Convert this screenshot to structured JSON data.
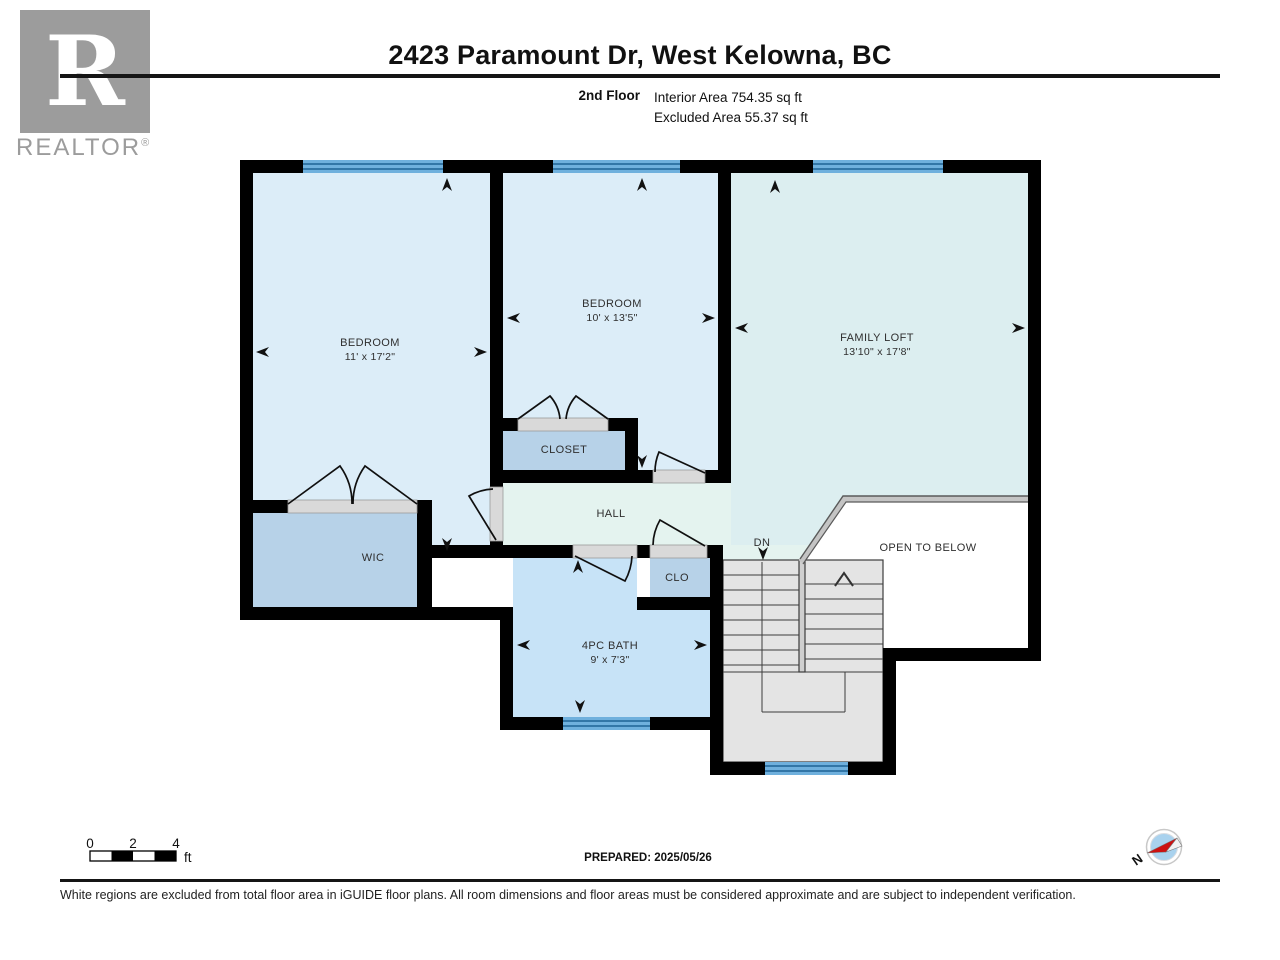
{
  "header": {
    "title": "2423 Paramount Dr, West Kelowna, BC",
    "floor_label": "2nd Floor",
    "interior_area": "Interior Area 754.35 sq ft",
    "excluded_area": "Excluded Area 55.37 sq ft",
    "logo": {
      "letter": "R",
      "wordmark": "REALTOR",
      "reg": "®"
    }
  },
  "rooms": {
    "bedroom1": {
      "name": "BEDROOM",
      "dims": "11' x 17'2\""
    },
    "bedroom2": {
      "name": "BEDROOM",
      "dims": "10' x 13'5\""
    },
    "family_loft": {
      "name": "FAMILY LOFT",
      "dims": "13'10\" x 17'8\""
    },
    "closet": {
      "name": "CLOSET"
    },
    "hall": {
      "name": "HALL"
    },
    "wic": {
      "name": "WIC"
    },
    "clo": {
      "name": "CLO"
    },
    "bath": {
      "name": "4PC BATH",
      "dims": "9' x 7'3\""
    },
    "open_to_below": {
      "name": "OPEN TO BELOW"
    },
    "stairs": {
      "dn_label": "DN"
    }
  },
  "footer": {
    "scale": {
      "labels": [
        "0",
        "2",
        "4"
      ],
      "unit": "ft"
    },
    "prepared": "PREPARED: 2025/05/26",
    "compass_n": "N",
    "disclaimer": "White regions are excluded from total floor area in iGUIDE floor plans. All room dimensions and floor areas must be considered approximate and are subject to independent verification."
  },
  "colors": {
    "wall": "#000000",
    "bedroom_fill": "#dcedf8",
    "loft_fill": "#dceef0",
    "hall_fill": "#e4f3ef",
    "closet_fill": "#b7d2e8",
    "bath_fill": "#c7e3f7",
    "stairs_fill": "#e4e4e4",
    "window_fill": "#6fb0dd",
    "window_line": "#1f6295",
    "door_gap": "#d9d9d9",
    "compass_inner": "#a9d2ee",
    "compass_red": "#cc1111",
    "logo_gray": "#9c9c9c"
  }
}
